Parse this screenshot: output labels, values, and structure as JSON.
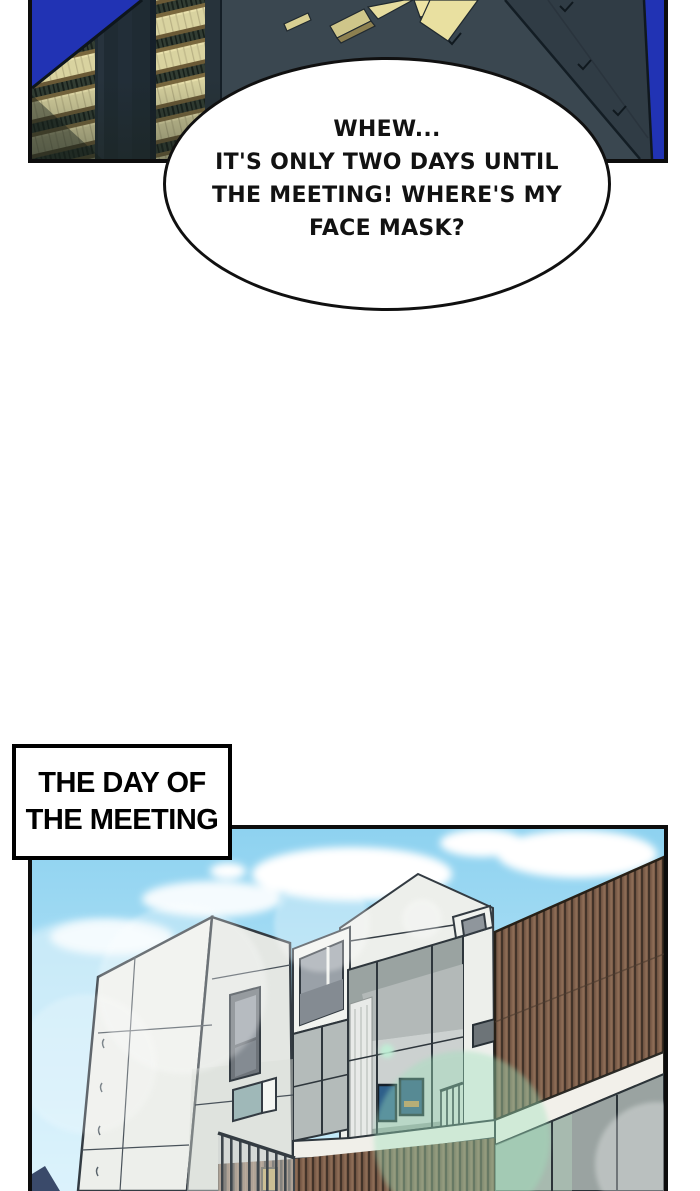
{
  "page": {
    "background": "#ffffff",
    "width": 700,
    "height": 1191
  },
  "panel_night": {
    "description": "night city buildings with lit windows",
    "border_color": "#0d0d0d",
    "colors": {
      "sky": "#2133b4",
      "building_base": "#3a4750",
      "building_dark": "#1f2b33",
      "roof_right": "#303c45",
      "window_glow": "#d9d3a0",
      "window_glow_bright": "#e9e0a8",
      "floor_band": "#6b5a36",
      "railing_band": "#323d33"
    }
  },
  "speech_bubble": {
    "lines": [
      "WHEW...",
      "IT'S ONLY TWO DAYS UNTIL",
      "THE MEETING! WHERE'S MY",
      "FACE MASK?"
    ],
    "fill": "#ffffff",
    "stroke": "#101010",
    "text_color": "#121212"
  },
  "caption": {
    "lines": [
      "THE DAY OF",
      "THE MEETING"
    ],
    "fill": "#ffffff",
    "border_color": "#000000",
    "text_color": "#000000"
  },
  "panel_day": {
    "description": "modern white house with wood-slat walls under blue sky",
    "border_color": "#0d0d0d",
    "colors": {
      "sky_top": "#8ed2f0",
      "sky_bottom": "#cdeefb",
      "cloud": "#ffffff",
      "building_white": "#edefeb",
      "building_shade": "#e4e7e3",
      "outline": "#333b42",
      "window_gray": "#9aa1a8",
      "window_frame": "#6e747a",
      "wood": "#7d5e4a",
      "wood_stripe": "#423329",
      "glass": "#9aa3a1",
      "glass_green": "#b7d8c2",
      "flare_green": "#9fe2bc",
      "curtain": "#e8eae8",
      "picture_blue": "#2e5f8a",
      "railing": "#3e464c",
      "lamp_gold": "#c9a84c",
      "distant_blue": "#3a4a6a",
      "fascia_white": "#f2f0ea"
    }
  }
}
